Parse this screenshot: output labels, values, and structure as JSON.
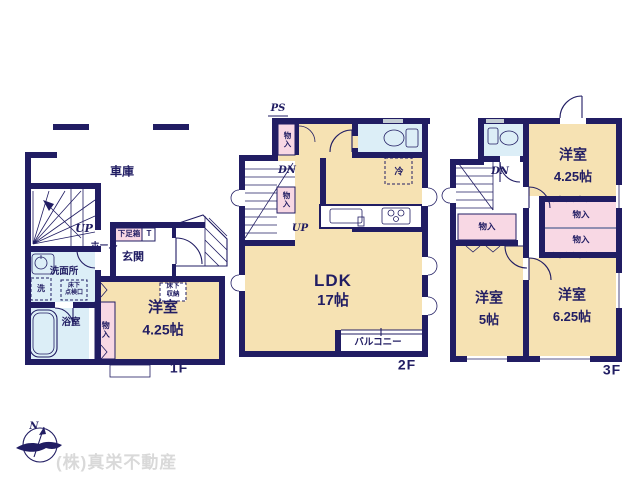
{
  "colors": {
    "wall_navy": "#211d63",
    "room_cream": "#f6e2b3",
    "wet_area_blue": "#dceef7",
    "closet_pink": "#f8d8e4",
    "watermark_gray": "#d9d9d9"
  },
  "f1": {
    "floor_label": "1F",
    "garage": "車庫",
    "up": "UP",
    "hall": "ホール",
    "shoebox": "下足箱",
    "wc": "T",
    "entrance": "玄関",
    "washroom": "洗面所",
    "washer": "洗",
    "hatch_l1": "床下",
    "hatch_l2": "点検口",
    "bath": "浴室",
    "closet": "物入",
    "room": "洋室",
    "room_size": "4.25帖",
    "storage_l1": "床下",
    "storage_l2": "収納"
  },
  "f2": {
    "floor_label": "2F",
    "ps": "PS",
    "closet_a": "物入",
    "dn": "DN",
    "closet_b": "物入",
    "up": "UP",
    "fridge": "冷",
    "ldk": "LDK",
    "ldk_size": "17帖",
    "balcony": "バルコニー"
  },
  "f3": {
    "floor_label": "3F",
    "dn": "DN",
    "room_a": "洋室",
    "room_a_size": "4.25帖",
    "closet_l": "物入",
    "closet_r1": "物入",
    "closet_r2": "物入",
    "room_b": "洋室",
    "room_b_size": "5帖",
    "room_c": "洋室",
    "room_c_size": "6.25帖"
  },
  "compass": {
    "north": "N"
  },
  "watermark": "(株)真栄不動産"
}
